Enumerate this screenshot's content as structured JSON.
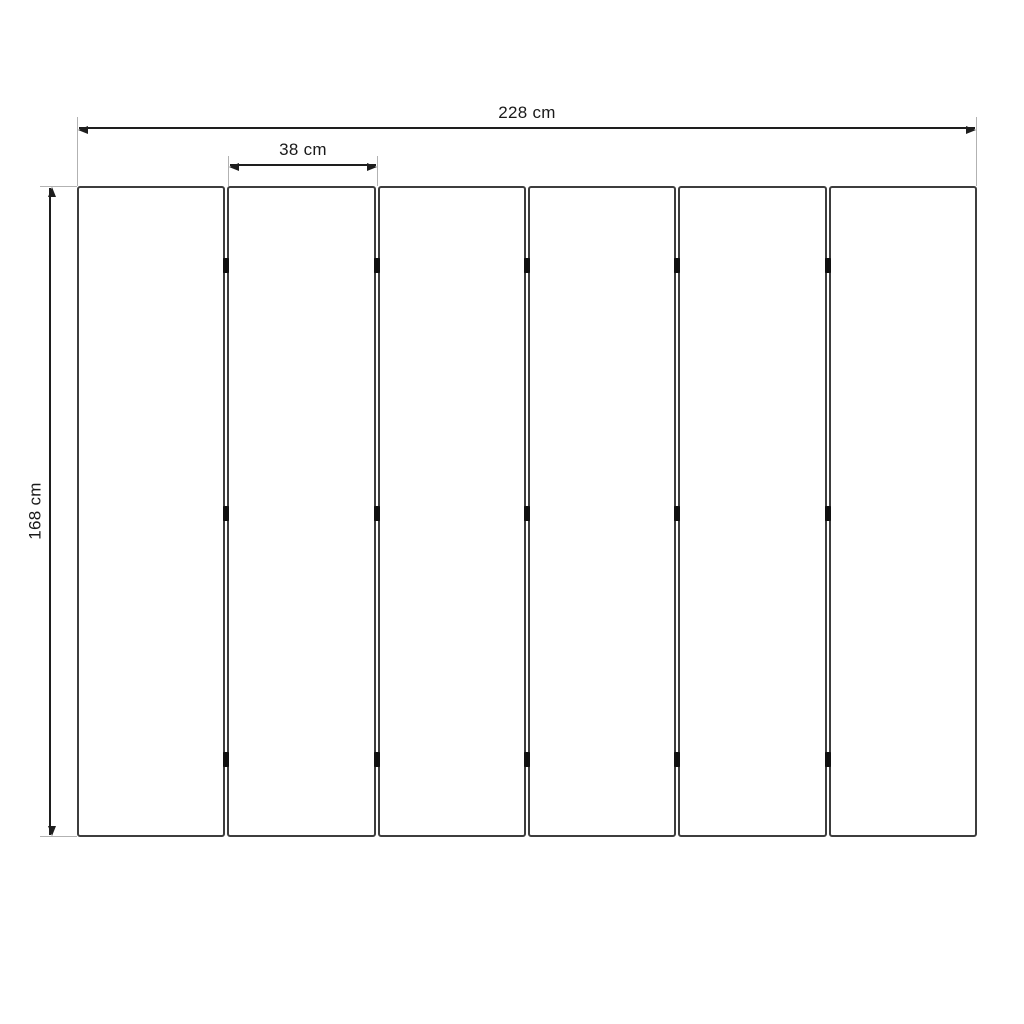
{
  "diagram": {
    "type": "dimensioned-drawing",
    "subject": "six-panel folding screen, front elevation",
    "labels": {
      "total_width": "228 cm",
      "panel_width": "38 cm",
      "height": "168 cm"
    },
    "panel_count": 6,
    "hinge_junction_count": 5,
    "hinge_rows_per_junction": 3,
    "colors": {
      "background": "#ffffff",
      "panel_border": "#3d3d3d",
      "dimension_line": "#1e1e1e",
      "extension_line": "#b2b2b2",
      "hinge": "#101010",
      "label_text": "#1a1a1a"
    }
  }
}
